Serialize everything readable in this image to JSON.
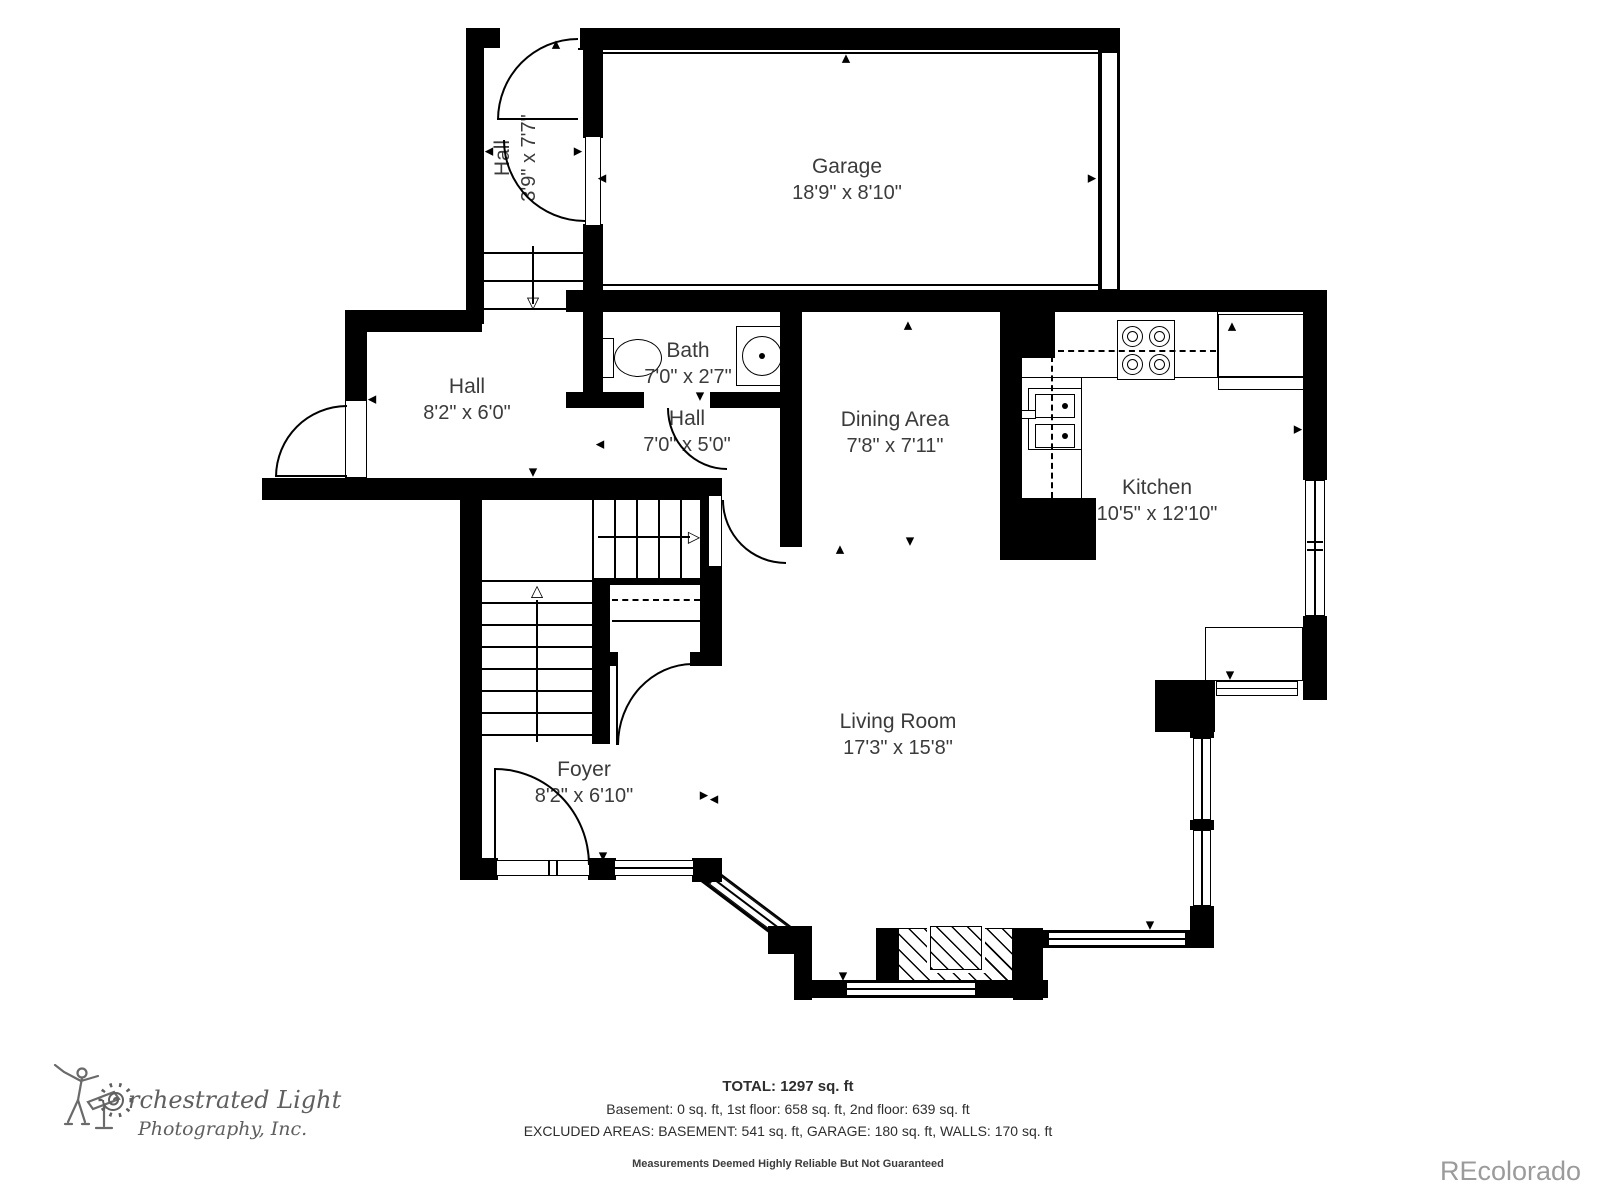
{
  "rooms": [
    {
      "name": "Hall",
      "dims": "3'9\" x 7'7\""
    },
    {
      "name": "Garage",
      "dims": "18'9\" x 8'10\""
    },
    {
      "name": "Bath",
      "dims": "7'0\" x 2'7\""
    },
    {
      "name": "Hall",
      "dims": "8'2\" x 6'0\""
    },
    {
      "name": "Hall",
      "dims": "7'0\" x 5'0\""
    },
    {
      "name": "Dining Area",
      "dims": "7'8\" x 7'11\""
    },
    {
      "name": "Kitchen",
      "dims": "10'5\" x 12'10\""
    },
    {
      "name": "Living Room",
      "dims": "17'3\" x 15'8\""
    },
    {
      "name": "Foyer",
      "dims": "8'2\" x 6'10\""
    }
  ],
  "summary": {
    "total": "TOTAL: 1297 sq. ft",
    "floors": "Basement: 0 sq. ft, 1st floor: 658 sq. ft, 2nd floor: 639 sq. ft",
    "excluded": "EXCLUDED AREAS: BASEMENT: 541 sq. ft, GARAGE: 180 sq. ft, WALLS: 170 sq. ft",
    "disclaimer": "Measurements Deemed Highly Reliable But Not Guaranteed"
  },
  "branding": {
    "logo_line1": "rchestrated Light",
    "logo_line2": "Photography, Inc.",
    "watermark": "REcolorado"
  },
  "colors": {
    "wall": "#000000",
    "label": "#3b3b3b",
    "logo": "#5f5f5f",
    "watermark": "#9b9b9b"
  }
}
